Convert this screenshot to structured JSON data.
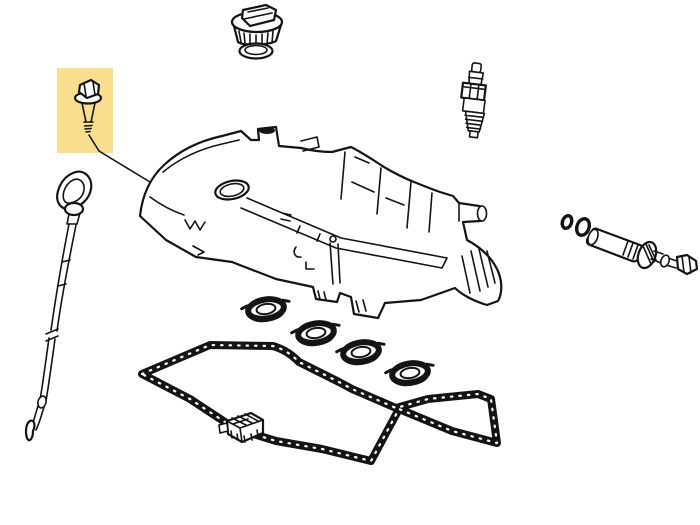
{
  "canvas": {
    "width": 700,
    "height": 525,
    "background_color": "#ffffff",
    "line_color": "#141414"
  },
  "highlight": {
    "color": "#F8DE8D",
    "x": 57,
    "y": 68,
    "width": 56,
    "height": 85,
    "target_part": "flange-bolt"
  },
  "parts": [
    {
      "name": "flange-bolt",
      "highlighted": true,
      "x": 74,
      "y": 78,
      "w": 30,
      "h": 58
    },
    {
      "name": "bolt-leader-line",
      "highlighted": false,
      "x": 89,
      "y": 134,
      "w": 61,
      "h": 49
    },
    {
      "name": "oil-filler-cap",
      "highlighted": false,
      "x": 230,
      "y": 3,
      "w": 54,
      "h": 42
    },
    {
      "name": "oil-filler-cap-seal",
      "highlighted": false,
      "x": 238,
      "y": 42,
      "w": 36,
      "h": 18
    },
    {
      "name": "spark-plug",
      "highlighted": false,
      "x": 458,
      "y": 62,
      "w": 32,
      "h": 76
    },
    {
      "name": "oil-dipstick",
      "highlighted": false,
      "x": 25,
      "y": 170,
      "w": 68,
      "h": 272
    },
    {
      "name": "cylinder-head-cover",
      "highlighted": false,
      "x": 138,
      "y": 126,
      "w": 366,
      "h": 180
    },
    {
      "name": "spark-plug-tube-seal-1",
      "highlighted": false,
      "x": 243,
      "y": 296,
      "w": 48,
      "h": 28
    },
    {
      "name": "spark-plug-tube-seal-2",
      "highlighted": false,
      "x": 293,
      "y": 320,
      "w": 48,
      "h": 28
    },
    {
      "name": "spark-plug-tube-seal-3",
      "highlighted": false,
      "x": 338,
      "y": 339,
      "w": 48,
      "h": 28
    },
    {
      "name": "spark-plug-tube-seal-4",
      "highlighted": false,
      "x": 387,
      "y": 360,
      "w": 48,
      "h": 28
    },
    {
      "name": "head-cover-gasket",
      "highlighted": false,
      "x": 138,
      "y": 341,
      "w": 364,
      "h": 124
    },
    {
      "name": "baffle-plate",
      "highlighted": false,
      "x": 218,
      "y": 412,
      "w": 48,
      "h": 34
    },
    {
      "name": "pcv-o-ring-small",
      "highlighted": false,
      "x": 561,
      "y": 215,
      "w": 12,
      "h": 14
    },
    {
      "name": "pcv-o-ring-large",
      "highlighted": false,
      "x": 575,
      "y": 218,
      "w": 16,
      "h": 18
    },
    {
      "name": "pcv-valve",
      "highlighted": false,
      "x": 586,
      "y": 226,
      "w": 72,
      "h": 44
    },
    {
      "name": "pcv-bolt",
      "highlighted": false,
      "x": 660,
      "y": 253,
      "w": 38,
      "h": 24
    }
  ]
}
